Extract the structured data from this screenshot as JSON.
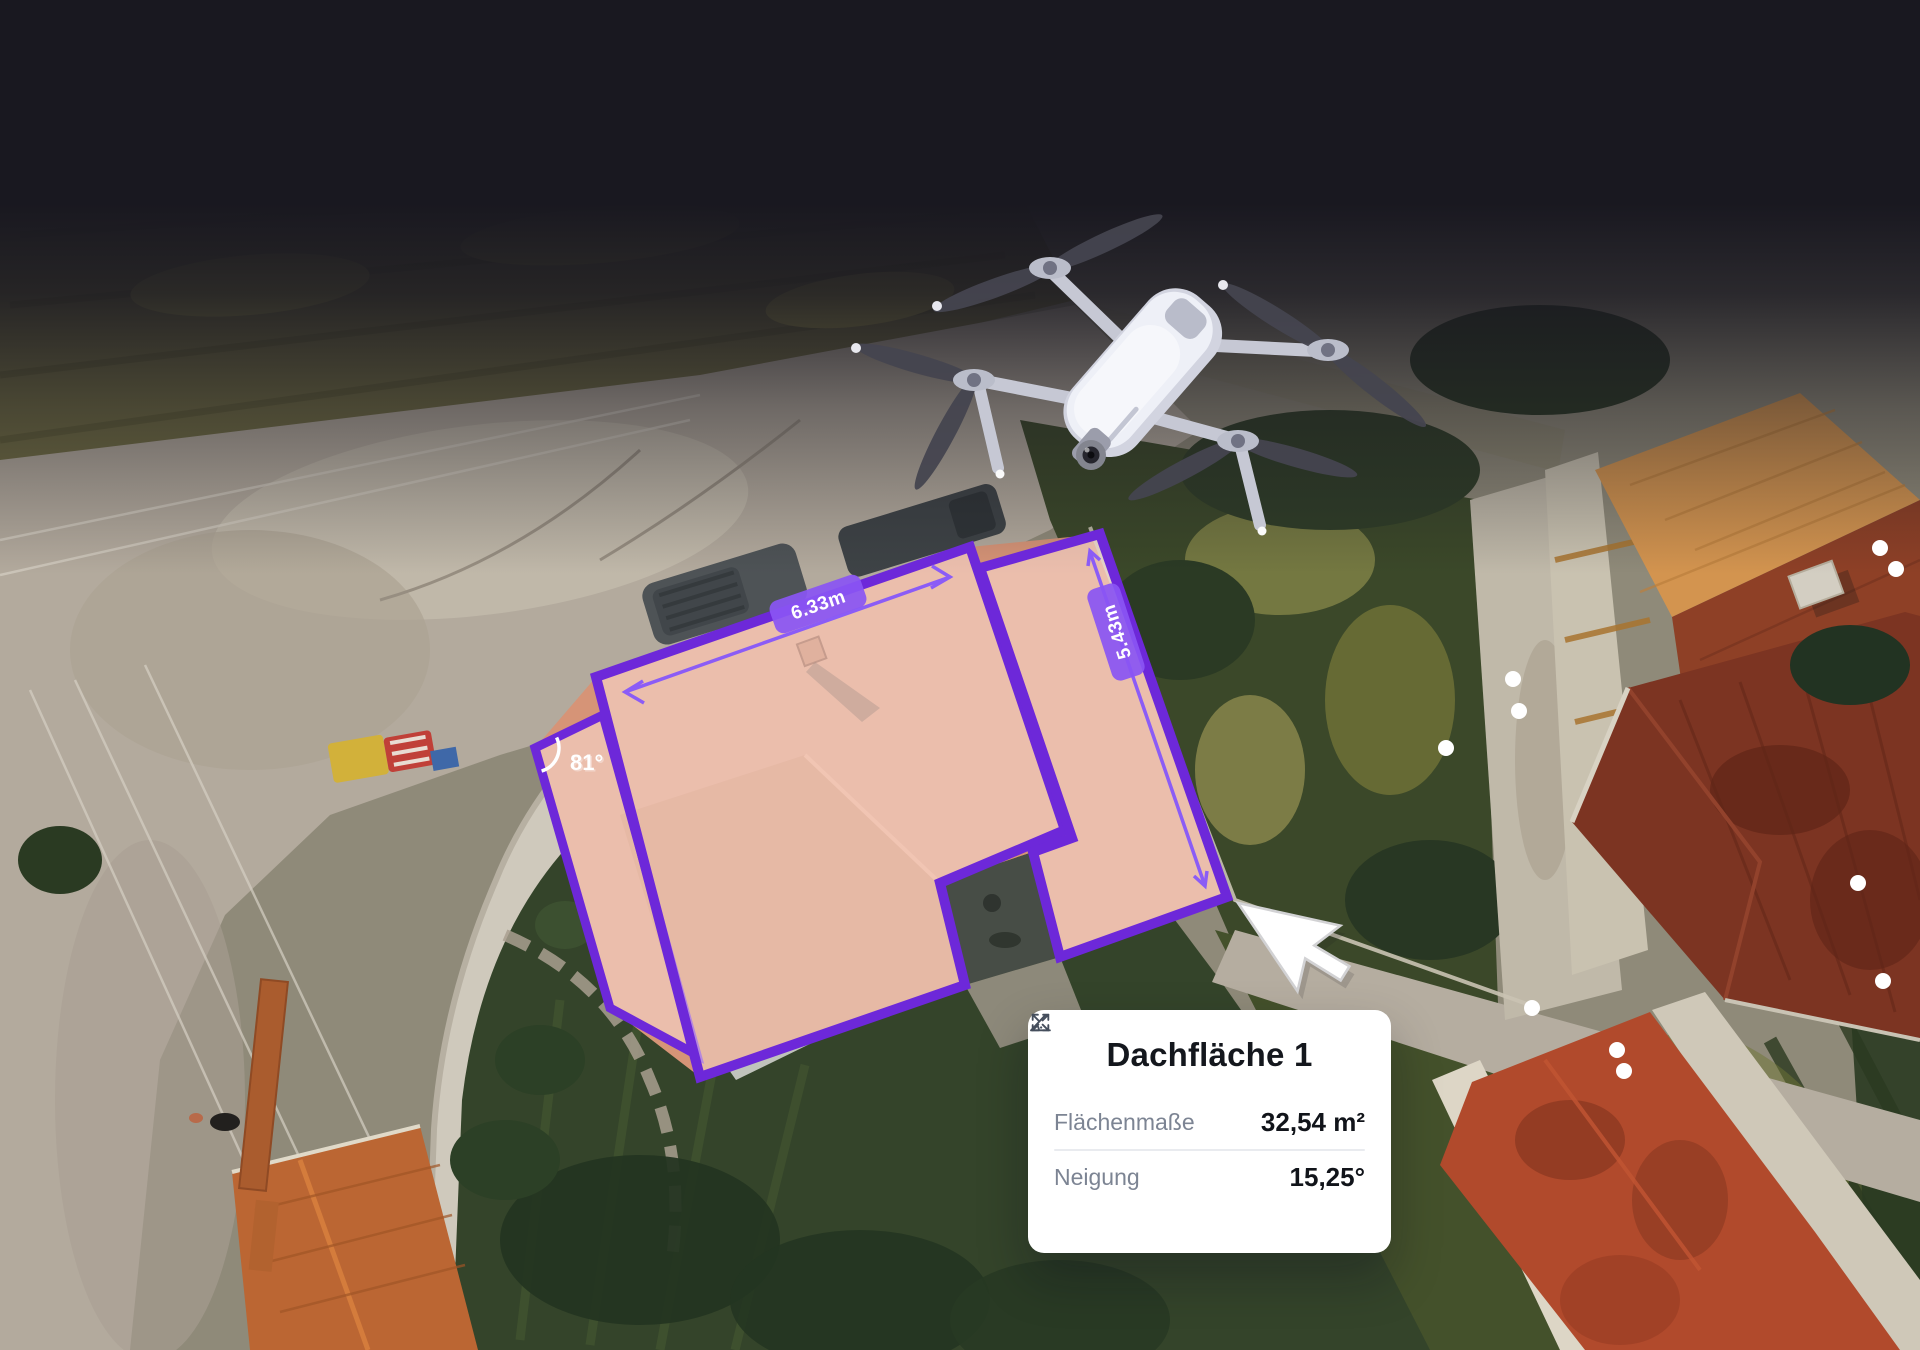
{
  "overlay": {
    "accent_color": "#6d28d9",
    "dimension_color": "#8b5cf6",
    "width_label": "6.33m",
    "height_label": "5.43m",
    "angle_label": "81°"
  },
  "card": {
    "title": "Dachfläche 1",
    "rows": [
      {
        "icon": "angle-icon",
        "label": "Flächenmaße",
        "value": "32,54 m²"
      },
      {
        "icon": "slope-icon",
        "label": "Neigung",
        "value": "15,25°"
      }
    ]
  }
}
